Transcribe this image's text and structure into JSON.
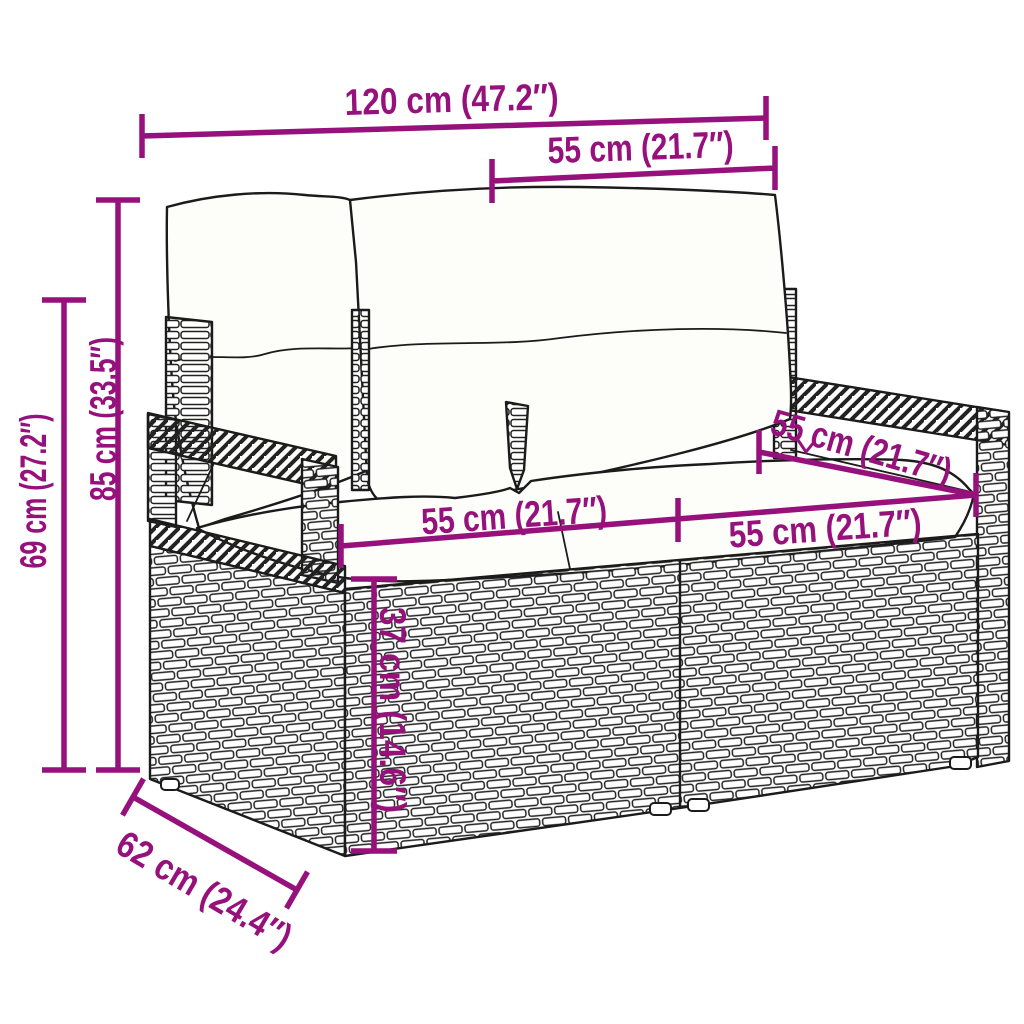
{
  "figure": {
    "type": "product-dimension-diagram",
    "subject": "2-seater poly rattan garden sofa with back and seat cushions",
    "colors": {
      "accent": "#97117C",
      "line": "#1b1b1b",
      "background": "#ffffff"
    }
  },
  "dimensions": {
    "total_width": {
      "label": "120 cm (47.2″)",
      "value_cm": 120,
      "value_in": 47.2
    },
    "back_cushion_width": {
      "label": "55 cm (21.7″)",
      "value_cm": 55,
      "value_in": 21.7
    },
    "total_height": {
      "label": "85 cm (33.5″)",
      "value_cm": 85,
      "value_in": 33.5
    },
    "armrest_height": {
      "label": "69 cm (27.2″)",
      "value_cm": 69,
      "value_in": 27.2
    },
    "seat_width_left": {
      "label": "55 cm (21.7″)",
      "value_cm": 55,
      "value_in": 21.7
    },
    "seat_width_right": {
      "label": "55 cm (21.7″)",
      "value_cm": 55,
      "value_in": 21.7
    },
    "seat_depth": {
      "label": "55 cm (21.7″)",
      "value_cm": 55,
      "value_in": 21.7
    },
    "seat_height": {
      "label": "37 cm (14.6″)",
      "value_cm": 37,
      "value_in": 14.6
    },
    "total_depth": {
      "label": "62 cm (24.4″)",
      "value_cm": 62,
      "value_in": 24.4
    }
  }
}
